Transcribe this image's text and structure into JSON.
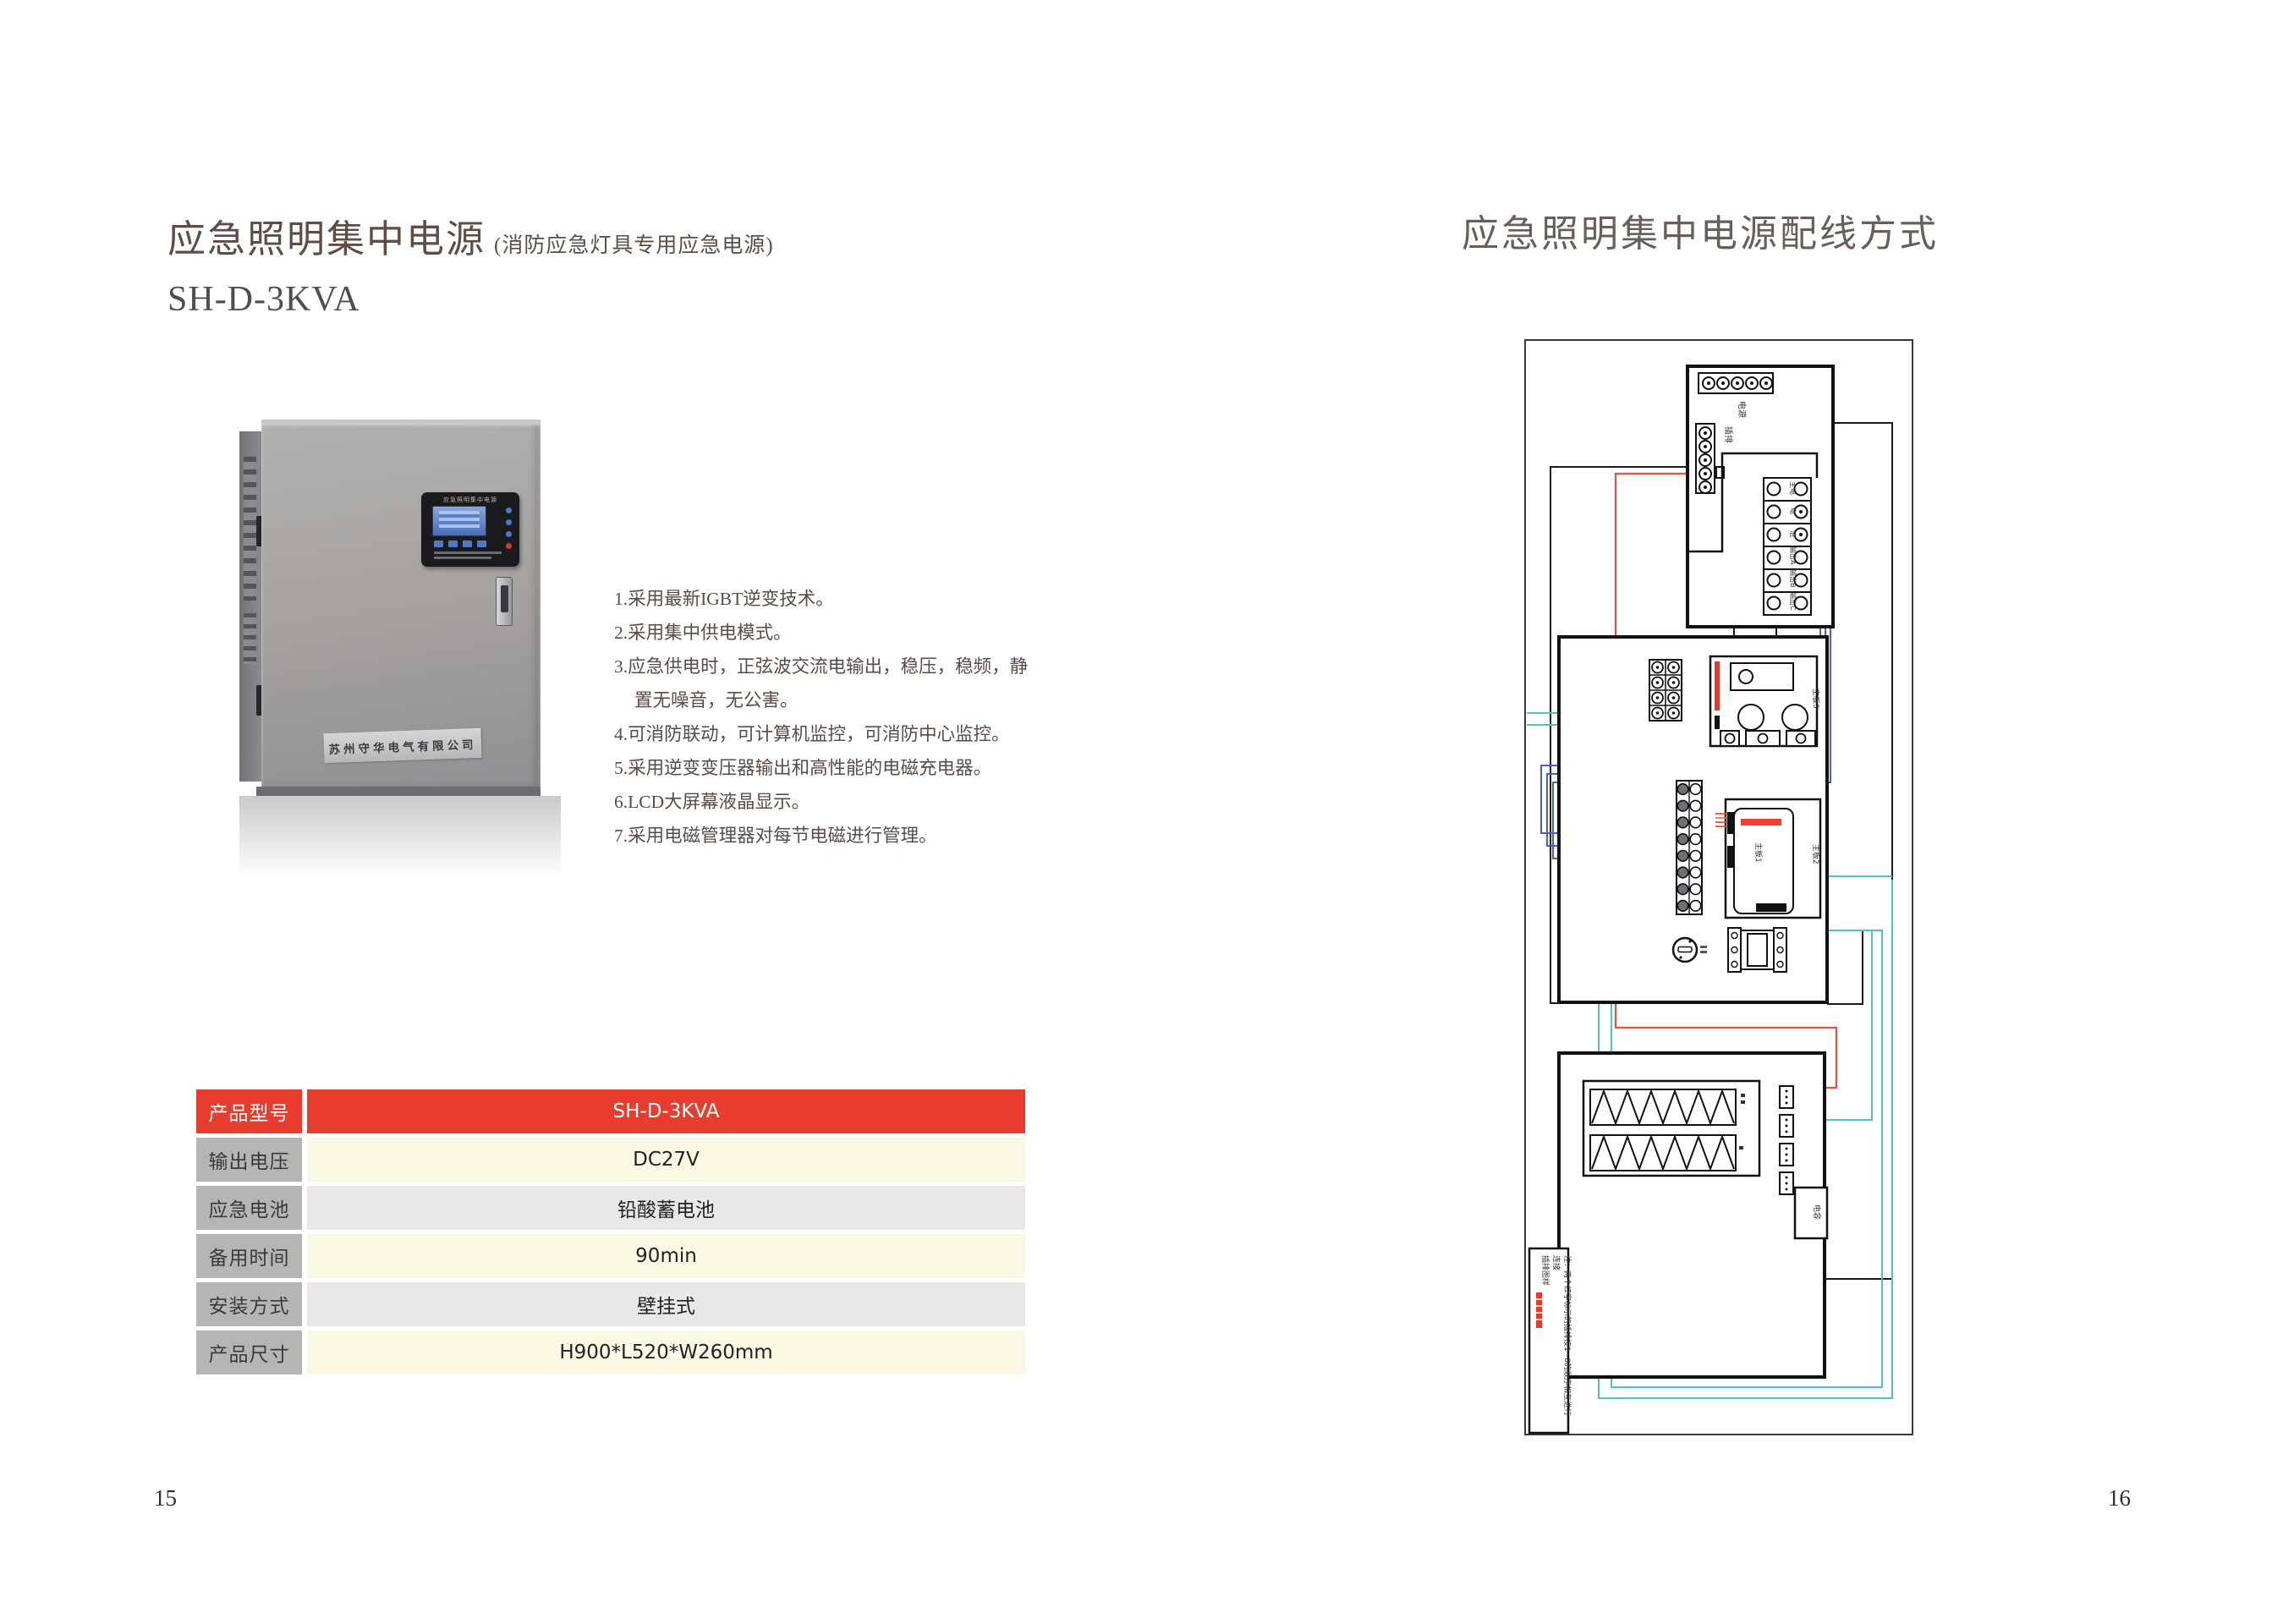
{
  "left_page": {
    "title": "应急照明集中电源",
    "title_suffix": "(消防应急灯具专用应急电源)",
    "model": "SH-D-3KVA",
    "product_photo": {
      "panel_title": "应急照明集中电源",
      "nameplate": "苏州守华电气有限公司",
      "led_colors": [
        "#4b79d0",
        "#4b79d0",
        "#4b79d0",
        "#d03a2e"
      ]
    },
    "features": [
      "1.采用最新IGBT逆变技术。",
      "2.采用集中供电模式。",
      "3.应急供电时，正弦波交流电输出，稳压，稳频，静置无噪音，无公害。",
      "4.可消防联动，可计算机监控，可消防中心监控。",
      "5.采用逆变变压器输出和高性能的电磁充电器。",
      "6.LCD大屏幕液晶显示。",
      "7.采用电磁管理器对每节电磁进行管理。"
    ],
    "spec_table": {
      "header": {
        "label": "产品型号",
        "value": "SH-D-3KVA"
      },
      "rows": [
        {
          "label": "输出电压",
          "value": "DC27V"
        },
        {
          "label": "应急电池",
          "value": "铅酸蓄电池"
        },
        {
          "label": "备用时间",
          "value": "90min"
        },
        {
          "label": "安装方式",
          "value": "壁挂式"
        },
        {
          "label": "产品尺寸",
          "value": "H900*L520*W260mm"
        }
      ],
      "header_color": "#e73c2e",
      "label_color": "#b5b5b5",
      "row_cream": "#faf7e2",
      "row_gray": "#eae8e6"
    },
    "page_number": "15"
  },
  "right_page": {
    "title": "应急照明集中电源配线方式",
    "diagram": {
      "power_strip_label": "电源",
      "vertical_strip_label": "插排",
      "terminal_block_labels": [
        "主电",
        "电",
        "池",
        "输出A",
        "输出B",
        "输出C"
      ],
      "board3_label": "主板3",
      "board1_label": "主板1",
      "board2_label": "主板2",
      "capacitor_label": "电容",
      "note_line1": "注：两个红字标示的插排按1~8的顺序相互进行",
      "note_line2": "连接",
      "note_line3": "插排图样",
      "wire_colors": {
        "red": "#e8503c",
        "blue": "#4a5fc0",
        "teal": "#53c3c0",
        "green": "#56b04c",
        "purple": "#b06fd8",
        "black": "#1a1a1a"
      }
    },
    "page_number": "16"
  }
}
